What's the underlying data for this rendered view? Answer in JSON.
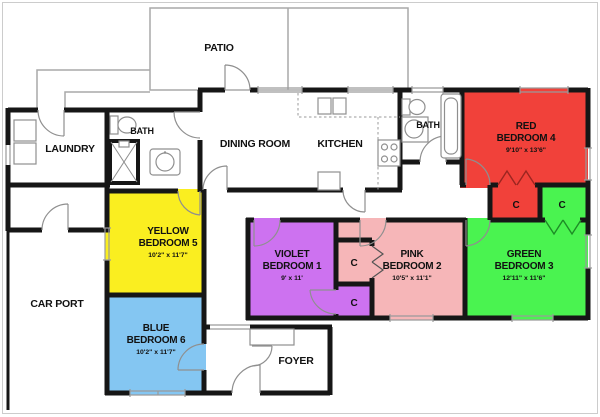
{
  "plan_title": "single-story house floor plan",
  "rooms": {
    "patio": {
      "label": "PATIO"
    },
    "laundry": {
      "label": "LAUNDRY"
    },
    "bath1": {
      "label": "BATH"
    },
    "bath2": {
      "label": "BATH"
    },
    "dining": {
      "label": "DINING ROOM"
    },
    "kitchen": {
      "label": "KITCHEN"
    },
    "carport": {
      "label": "CAR PORT"
    },
    "foyer": {
      "label": "FOYER"
    },
    "bedroom1": {
      "name": "VIOLET",
      "type": "BEDROOM 1",
      "dims": "9' x 11'",
      "color": "#cd72f0"
    },
    "bedroom2": {
      "name": "PINK",
      "type": "BEDROOM 2",
      "dims": "10'5\" x 11'1\"",
      "color": "#f6b6b8"
    },
    "bedroom3": {
      "name": "GREEN",
      "type": "BEDROOM 3",
      "dims": "12'11\" x 11'6\"",
      "color": "#4af350"
    },
    "bedroom4": {
      "name": "RED",
      "type": "BEDROOM 4",
      "dims": "9'10\" x 13'6\"",
      "color": "#f1413a"
    },
    "bedroom5": {
      "name": "YELLOW",
      "type": "BEDROOM 5",
      "dims": "10'2\" x 11'7\"",
      "color": "#faee20"
    },
    "bedroom6": {
      "name": "BLUE",
      "type": "BEDROOM 6",
      "dims": "10'2\" x 11'7\"",
      "color": "#84c6f2"
    }
  },
  "closets": {
    "label": "C",
    "red_letter": "#9b2520",
    "green_letter": "#1d8c26",
    "dark_letter": "#222222"
  },
  "palette": {
    "wall": "#161616",
    "line": "#9a9a9a",
    "background": "#ffffff"
  }
}
